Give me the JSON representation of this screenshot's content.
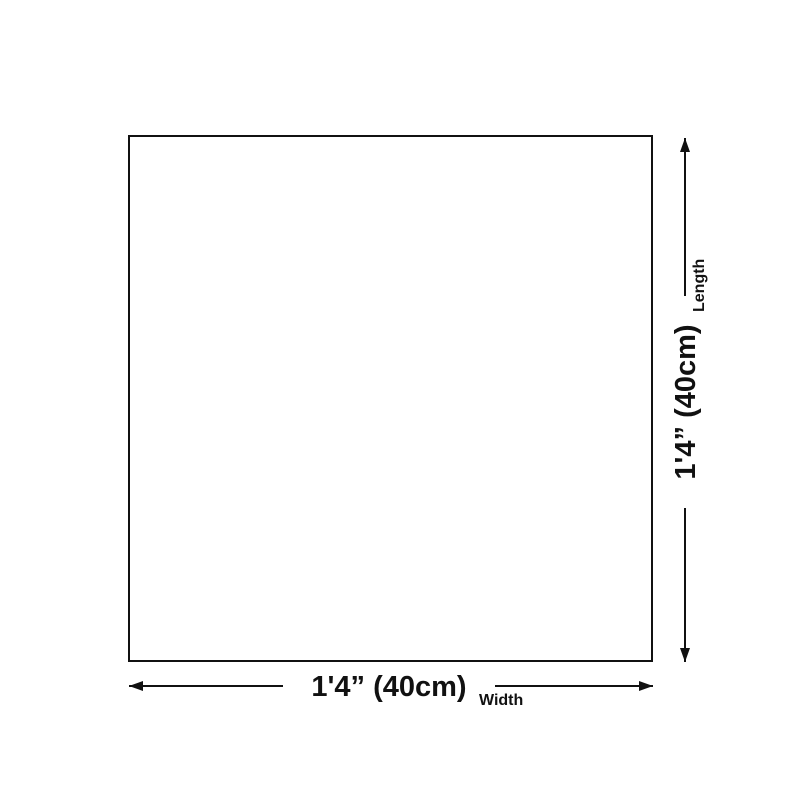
{
  "page": {
    "background": "#ffffff"
  },
  "diagram": {
    "type": "product-dimension-diagram",
    "line_color": "#111111",
    "box_fill": "#ffffff",
    "width": {
      "value": "1'4” (40cm)",
      "label": "Width"
    },
    "length": {
      "value": "1'4” (40cm)",
      "label": "Length"
    }
  }
}
